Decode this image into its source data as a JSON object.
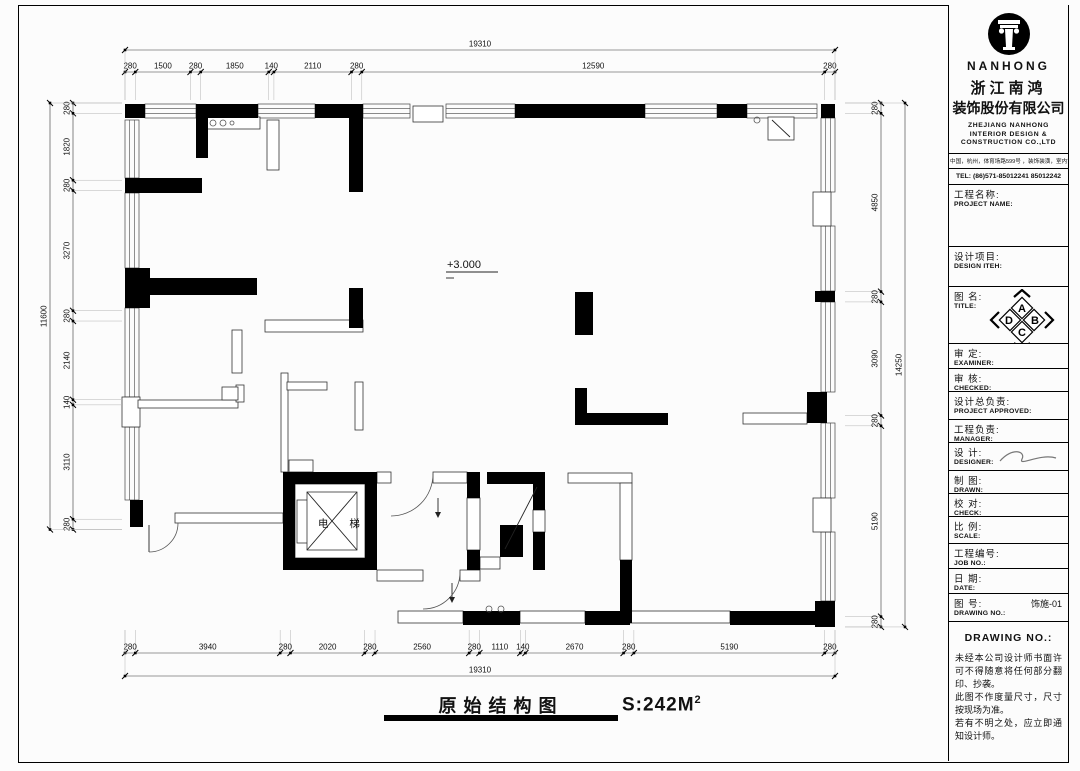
{
  "company": {
    "logo_text": "NANHONG",
    "name_cn_1": "浙江南鸿",
    "name_cn_2": "装饰股份有限公司",
    "name_en_1": "ZHEJIANG NANHONG",
    "name_en_2": "INTERIOR DESIGN &",
    "name_en_3": "CONSTRUCTION CO.,LTD",
    "address": "中国，杭州，体育场路599号 ，装饰装潢，室内设计",
    "tel": "TEL: (86)571-85012241  85012242"
  },
  "title_block": {
    "rows": [
      {
        "cn": "工程名称:",
        "en": "PROJECT NAME:",
        "h": 62
      },
      {
        "cn": "设计项目:",
        "en": "DESIGN ITEH:",
        "h": 40
      },
      {
        "cn": "图  名:",
        "en": "TITLE:",
        "h": 57,
        "compass": true
      },
      {
        "cn": "审  定:",
        "en": "EXAMINER:",
        "h": 25
      },
      {
        "cn": "审  核:",
        "en": "CHECKED:",
        "h": 23
      },
      {
        "cn": "设计总负责:",
        "en": "PROJECT APPROVED:",
        "h": 28
      },
      {
        "cn": "工程负责:",
        "en": "MANAGER:",
        "h": 23
      },
      {
        "cn": "设  计:",
        "en": "DESIGNER:",
        "h": 28,
        "signature": true
      },
      {
        "cn": "制  图:",
        "en": "DRAWN:",
        "h": 23
      },
      {
        "cn": "校  对:",
        "en": "CHECK:",
        "h": 23
      },
      {
        "cn": "比  例:",
        "en": "SCALE:",
        "h": 27
      },
      {
        "cn": "工程编号:",
        "en": "JOB  NO.:",
        "h": 25
      },
      {
        "cn": "日  期:",
        "en": "DATE:",
        "h": 25
      },
      {
        "cn": "图  号:",
        "en": "DRAWING NO.:",
        "h": 28,
        "value": "饰施-01"
      }
    ],
    "compass_letters": [
      "A",
      "B",
      "C",
      "D"
    ],
    "notes_heading": "DRAWING NO.:",
    "notes": [
      "未经本公司设计师书面许可不得随意将任何部分翻印、抄袭。",
      "此图不作度量尺寸，尺寸按现场为准。",
      "若有不明之处，应立即通知设计师。"
    ]
  },
  "caption": {
    "title": "原始结构图",
    "area": "S:242M",
    "area_sup": "2"
  },
  "plan_labels": {
    "level": "+3.000",
    "elevator": "电 梯"
  },
  "dimensions": {
    "top": {
      "total": 19310,
      "segments": [
        280,
        1500,
        280,
        1850,
        140,
        2110,
        280,
        12590,
        280
      ]
    },
    "bottom": {
      "total": 19310,
      "segments": [
        280,
        3940,
        280,
        2020,
        280,
        2560,
        280,
        1110,
        140,
        2670,
        280,
        5190,
        280
      ]
    },
    "left": {
      "total": 11600,
      "segments": [
        280,
        1820,
        280,
        3270,
        280,
        2140,
        140,
        3110,
        280
      ]
    },
    "right": {
      "total": 14250,
      "segments": [
        280,
        4850,
        280,
        3090,
        280,
        5190,
        280
      ]
    }
  },
  "floor_plan": {
    "blacks": [
      [
        125,
        104,
        20,
        14
      ],
      [
        196,
        104,
        62,
        14
      ],
      [
        315,
        104,
        48,
        14
      ],
      [
        515,
        104,
        130,
        14
      ],
      [
        717,
        104,
        30,
        14
      ],
      [
        821,
        104,
        14,
        14
      ],
      [
        196,
        116,
        12,
        42
      ],
      [
        349,
        116,
        14,
        76
      ],
      [
        349,
        288,
        14,
        40
      ],
      [
        125,
        178,
        77,
        15
      ],
      [
        125,
        268,
        25,
        40
      ],
      [
        139,
        278,
        118,
        17
      ],
      [
        130,
        500,
        13,
        27
      ],
      [
        815,
        291,
        20,
        11
      ],
      [
        807,
        392,
        20,
        31
      ],
      [
        815,
        601,
        20,
        26
      ],
      [
        575,
        292,
        18,
        43
      ],
      [
        575,
        388,
        12,
        37
      ],
      [
        575,
        413,
        93,
        12
      ],
      [
        620,
        560,
        12,
        63
      ],
      [
        463,
        611,
        57,
        14
      ],
      [
        585,
        611,
        45,
        14
      ],
      [
        730,
        611,
        87,
        14
      ],
      [
        283,
        472,
        94,
        12
      ],
      [
        283,
        558,
        94,
        12
      ],
      [
        283,
        484,
        12,
        74
      ],
      [
        365,
        484,
        12,
        74
      ],
      [
        467,
        472,
        13,
        26
      ],
      [
        467,
        550,
        13,
        20
      ],
      [
        487,
        472,
        46,
        12
      ],
      [
        533,
        472,
        12,
        38
      ],
      [
        533,
        532,
        12,
        38
      ],
      [
        500,
        525,
        23,
        32
      ]
    ],
    "outlines": [
      [
        267,
        120,
        12,
        50
      ],
      [
        122,
        397,
        18,
        30
      ],
      [
        265,
        320,
        98,
        12
      ],
      [
        232,
        330,
        10,
        43
      ],
      [
        281,
        373,
        7,
        99
      ],
      [
        287,
        382,
        40,
        8
      ],
      [
        355,
        382,
        8,
        48
      ],
      [
        138,
        400,
        100,
        8
      ],
      [
        236,
        385,
        8,
        17
      ],
      [
        222,
        387,
        16,
        13
      ],
      [
        289,
        460,
        24,
        12
      ],
      [
        175,
        513,
        108,
        10
      ],
      [
        743,
        413,
        64,
        11
      ],
      [
        768,
        117,
        26,
        23
      ],
      [
        568,
        473,
        64,
        10
      ],
      [
        620,
        483,
        12,
        77
      ],
      [
        520,
        611,
        65,
        12
      ],
      [
        630,
        611,
        100,
        12
      ],
      [
        398,
        611,
        65,
        12
      ],
      [
        377,
        472,
        14,
        11
      ],
      [
        433,
        472,
        34,
        11
      ],
      [
        467,
        498,
        13,
        52
      ],
      [
        480,
        557,
        20,
        12
      ],
      [
        533,
        510,
        12,
        22
      ],
      [
        377,
        570,
        46,
        11
      ],
      [
        460,
        570,
        20,
        11
      ],
      [
        295,
        484,
        70,
        74
      ],
      [
        297,
        500,
        13,
        43
      ],
      [
        307,
        492,
        50,
        58
      ],
      [
        205,
        117,
        55,
        12
      ],
      [
        413,
        106,
        30,
        16
      ],
      [
        813,
        192,
        18,
        34
      ],
      [
        813,
        498,
        18,
        34
      ]
    ],
    "windows": [
      [
        145,
        104,
        51,
        14,
        "h"
      ],
      [
        258,
        104,
        57,
        14,
        "h"
      ],
      [
        363,
        104,
        47,
        14,
        "h"
      ],
      [
        446,
        104,
        69,
        14,
        "h"
      ],
      [
        645,
        104,
        72,
        14,
        "h"
      ],
      [
        747,
        104,
        70,
        14,
        "h"
      ],
      [
        125,
        120,
        14,
        58,
        "v"
      ],
      [
        125,
        193,
        14,
        75,
        "v"
      ],
      [
        125,
        308,
        14,
        89,
        "v"
      ],
      [
        125,
        427,
        14,
        73,
        "v"
      ],
      [
        821,
        118,
        14,
        74,
        "v"
      ],
      [
        821,
        226,
        14,
        65,
        "v"
      ],
      [
        821,
        302,
        14,
        90,
        "v"
      ],
      [
        821,
        423,
        14,
        75,
        "v"
      ],
      [
        821,
        532,
        14,
        69,
        "v"
      ]
    ],
    "lines": [
      [
        307,
        492,
        357,
        550
      ],
      [
        357,
        492,
        307,
        550
      ],
      [
        537,
        487,
        505,
        549
      ],
      [
        772,
        120,
        790,
        137
      ],
      [
        446,
        272,
        498,
        272
      ],
      [
        446,
        278,
        454,
        278
      ],
      [
        149,
        525,
        149,
        552
      ],
      [
        438,
        498,
        438,
        514
      ],
      [
        452,
        583,
        452,
        599
      ]
    ],
    "arcs": [
      "M433,474 A42,42 0 0 1 391,516",
      "M460,572 A37,37 0 0 1 423,609",
      "M149,552 A29,29 0 0 0 178,523"
    ],
    "arrowheads": [
      [
        435,
        512,
        441,
        512,
        438,
        518
      ],
      [
        449,
        597,
        455,
        597,
        452,
        603
      ]
    ],
    "circles": [
      [
        213,
        123,
        3
      ],
      [
        223,
        123,
        3
      ],
      [
        232,
        123,
        2
      ],
      [
        489,
        609,
        3
      ],
      [
        501,
        609,
        3
      ],
      [
        757,
        120,
        3
      ]
    ]
  }
}
